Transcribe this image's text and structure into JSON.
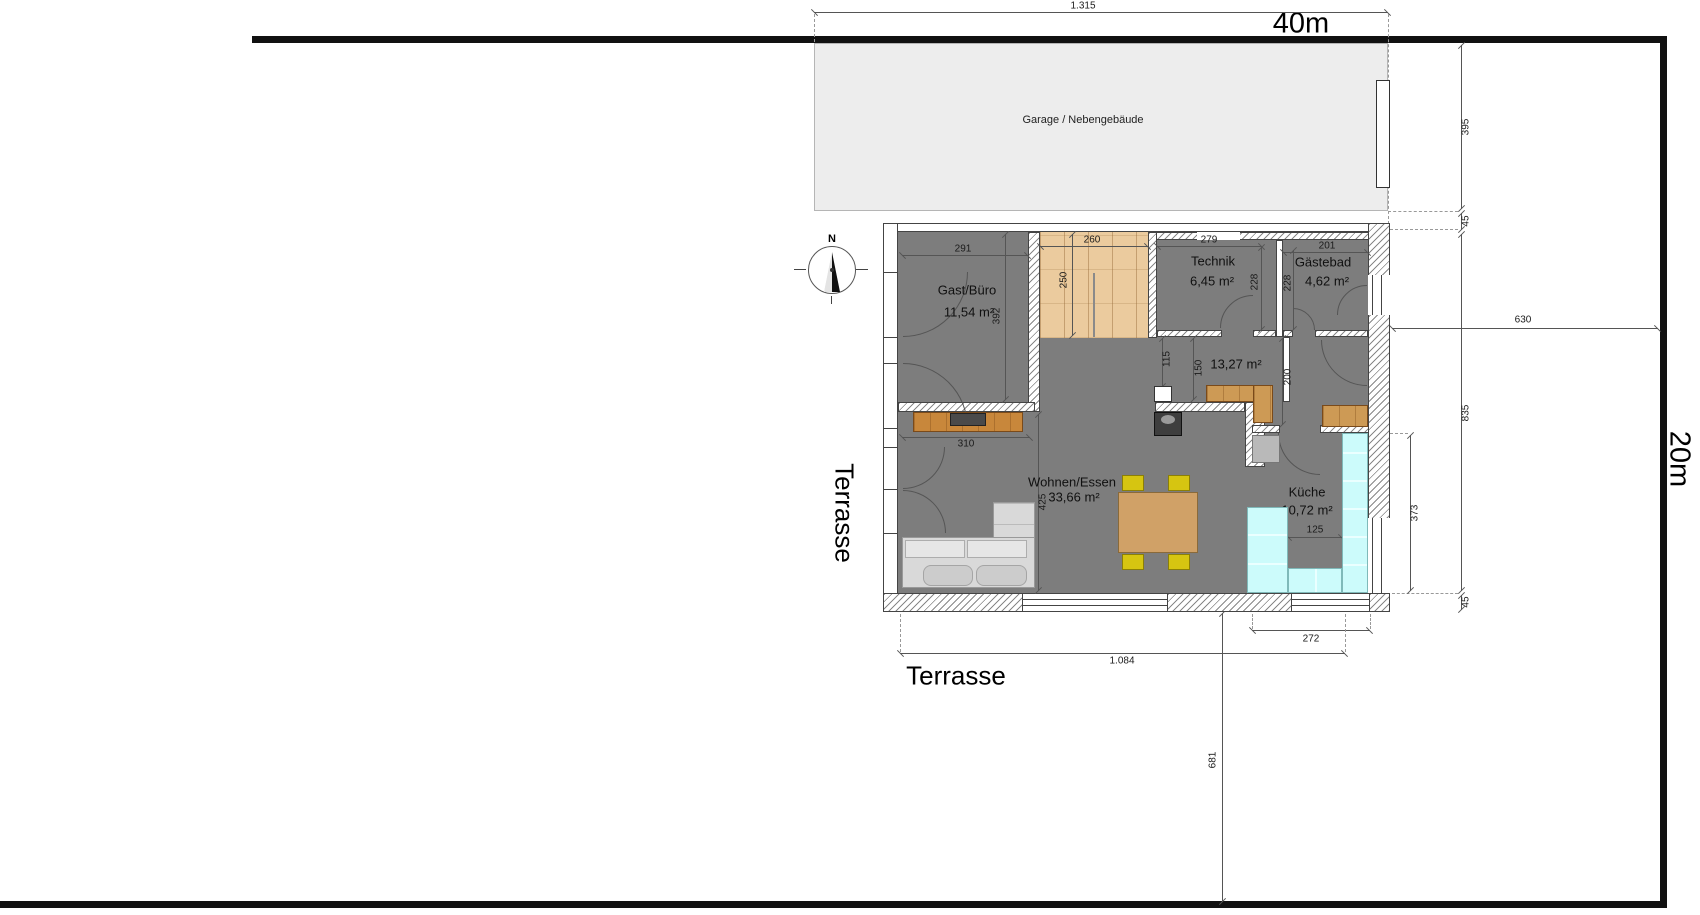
{
  "site": {
    "plot_width_label": "40m",
    "plot_depth_label": "20m",
    "garage_label": "Garage / Nebengebäude",
    "terrace_left_label": "Terrasse",
    "terrace_bottom_label": "Terrasse",
    "compass_north_label": "N"
  },
  "rooms": {
    "gast_buero": {
      "name": "Gast/Büro",
      "area": "11,54 m²"
    },
    "technik": {
      "name": "Technik",
      "area": "6,45 m²"
    },
    "gaestebad": {
      "name": "Gästebad",
      "area": "4,62 m²"
    },
    "flur": {
      "area": "13,27 m²"
    },
    "wohnen_essen": {
      "name": "Wohnen/Essen",
      "area": "33,66 m²"
    },
    "kueche": {
      "name": "Küche",
      "area": "10,72 m²"
    }
  },
  "dimensions": {
    "plot_top": "1.315",
    "garage_depth": "395",
    "gap_garage_house": "45",
    "house_to_right_boundary": "630",
    "house_depth": "835",
    "house_bottom_offset": "45",
    "kueche_right_depth": "373",
    "kueche_bottom_width": "272",
    "house_width": "1.084",
    "house_to_bottom_boundary": "681",
    "gast_width": "291",
    "gast_depth": "392",
    "entry_width": "260",
    "entry_depth": "250",
    "technik_width": "279",
    "technik_depth": "228",
    "gaestebad_width": "201",
    "gaestebad_depth": "228",
    "flur_dim_a": "115",
    "flur_dim_b": "150",
    "flur_dim_c": "200",
    "sideboard_width": "310",
    "wohnen_depth": "425",
    "kueche_counter_width": "125"
  },
  "colors": {
    "boundary": "#111111",
    "floor_gray": "#7d7d7d",
    "entry_wood": "#ebcb9e",
    "kitchen_counter": "#ccfbfb",
    "furniture_wood": "#cd9a55",
    "chair_yellow": "#d6c511",
    "garage_fill": "#ededed"
  }
}
